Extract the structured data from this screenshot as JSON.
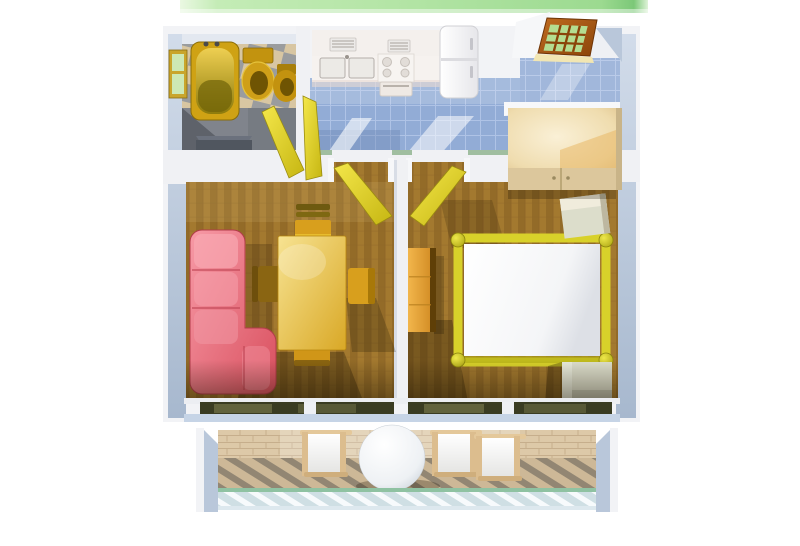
{
  "scene": {
    "kind": "3d-apartment-floorplan-top-view-render",
    "rooms": [
      {
        "id": "bathroom",
        "furniture": [
          "window",
          "bathtub",
          "toilet",
          "bidet",
          "open-yellow-door"
        ]
      },
      {
        "id": "kitchen",
        "furniture": [
          "wall-cabinets",
          "double-sink",
          "stove",
          "counter",
          "refrigerator"
        ]
      },
      {
        "id": "hallway",
        "furniture": [
          "entry-door-with-glass",
          "wardrobe"
        ]
      },
      {
        "id": "living-room",
        "furniture": [
          "corner-sofa",
          "dining-table",
          "chair-top",
          "chair-right",
          "chair-bottom",
          "chair-left",
          "open-yellow-door",
          "window-wall"
        ]
      },
      {
        "id": "bedroom",
        "furniture": [
          "double-bed",
          "nightstand-top",
          "nightstand-bottom",
          "dresser",
          "open-yellow-door",
          "window-wall"
        ]
      },
      {
        "id": "balcony",
        "furniture": [
          "round-table",
          "chair-left",
          "chair-middle",
          "chair-right",
          "railing"
        ]
      }
    ]
  },
  "palette": {
    "bg": "#ffffff",
    "grass-green": "#aee3a0",
    "wall-outer": "#f2f3f6",
    "wall-face": "#b9c7da",
    "wall-top": "#e3e8f0",
    "bath-tile-beige": "#d8c6a2",
    "bath-tile-gray": "#9a9c9e",
    "bath-floor-gray": "#80848c",
    "bath-alcove-dark": "#50565f",
    "fixture-gold": "#cfa214",
    "fixture-gold-dark": "#6f5403",
    "window-frame-gold": "#c9a52c",
    "window-pane-green": "#cde8b4",
    "door-yellow": "#e8da2e",
    "kitchen-tile-blue": "#92acd6",
    "kitchen-tile-line": "#b7c9ea",
    "counter-white": "#f6f2ef",
    "fridge-white": "#fbfbfd",
    "entry-door-wood": "#a85a14",
    "entry-door-glass": "#b4dd90",
    "wardrobe-cream": "#eedfba",
    "carpet-brown": "#a3792f",
    "carpet-brown-dark": "#936b28",
    "sofa-pink": "#e25f6d",
    "table-gold": "#e9c645",
    "chair-gold": "#d89f1d",
    "bed-frame-yellow": "#d8d12a",
    "mattress-white": "#ffffff",
    "nightstand-sage": "#dcddcb",
    "dresser-orange": "#e8a93e",
    "window-glass-olive": "#3a3c22",
    "sill-blue": "#c6d4e6",
    "balcony-stone": "#cdb897",
    "balcony-stripe": "#837a6a",
    "railing-slat-white": "#f7fafc",
    "railing-green": "#8fc2a2",
    "chair-frame-tan": "#dcbd8e"
  }
}
